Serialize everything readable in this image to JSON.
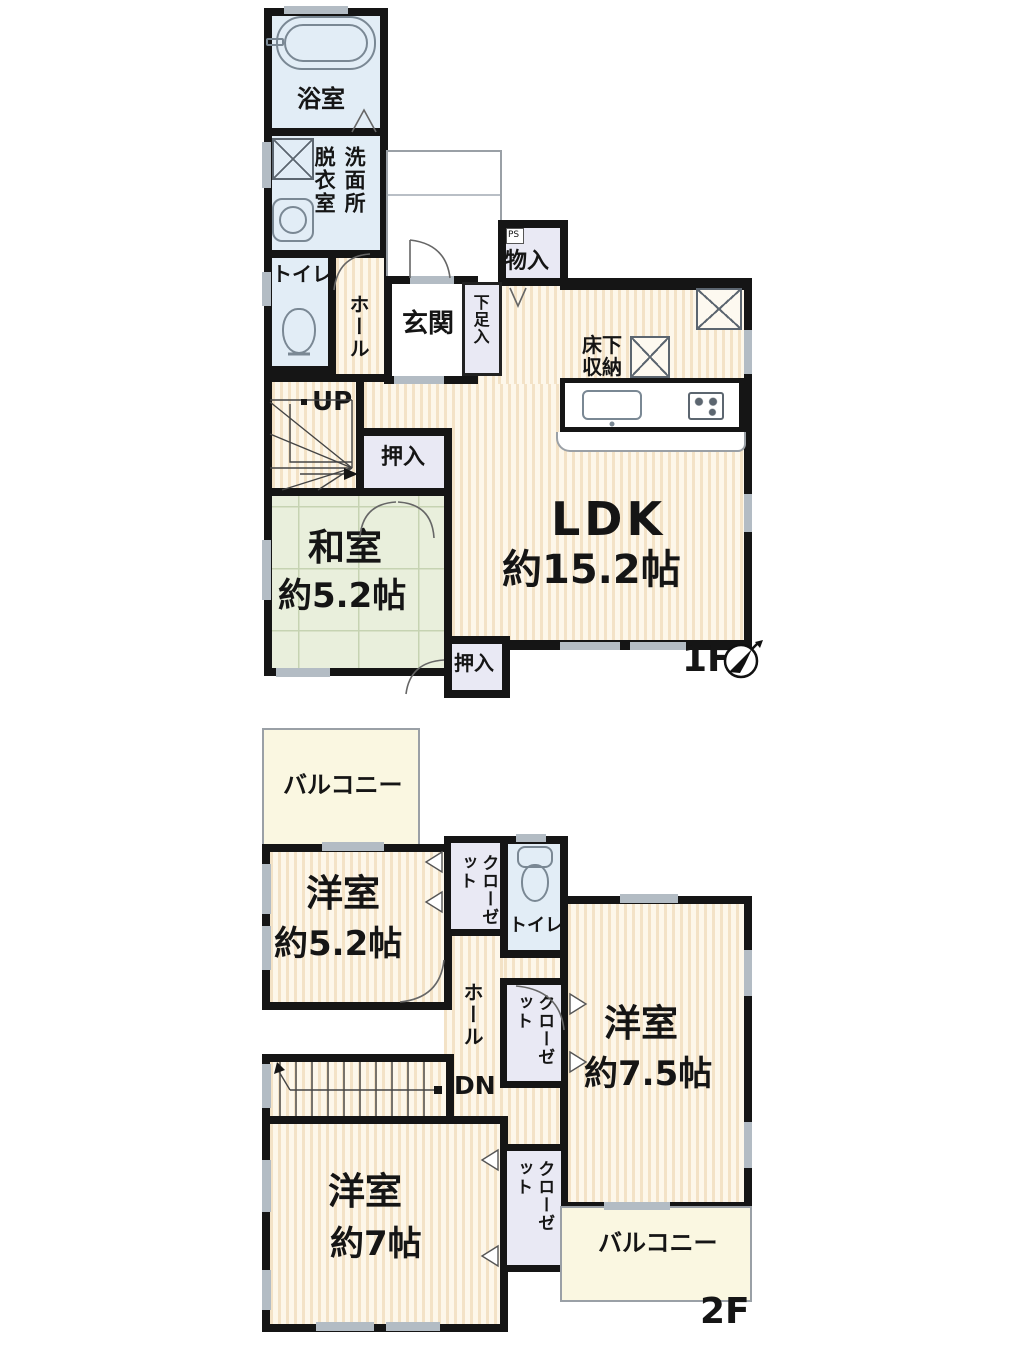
{
  "f1": {
    "label": "1F",
    "bath": "浴室",
    "dressing": "脱衣室",
    "washroom": "洗面所",
    "toilet": "トイレ",
    "hall": "ホール",
    "entrance": "玄関",
    "shoe_box": "下足入",
    "storage": "物入",
    "ps": "PS",
    "underfloor": "床下収納",
    "ldk": "LDK",
    "ldk_size": "約15.2帖",
    "up": "UP",
    "closet_a": "押入",
    "tatami_room": "和室",
    "tatami_size": "約5.2帖",
    "closet_b": "押入"
  },
  "f2": {
    "label": "2F",
    "balcony_a": "バルコニー",
    "room_a": "洋室",
    "room_a_size": "約5.2帖",
    "closet_a": "クローゼット",
    "toilet": "トイレ",
    "hall": "ホール",
    "dn": "DN",
    "room_b": "洋室",
    "room_b_size": "約7.5帖",
    "closet_b": "クローゼット",
    "room_c": "洋室",
    "room_c_size": "約7帖",
    "closet_c": "クローゼット",
    "balcony_b": "バルコニー"
  },
  "colors": {
    "wall": "#151515",
    "floor_stripe": "#f3e2c6",
    "floor_base": "#fdf7ea",
    "tatami": "#e9efdc",
    "wet_room": "#e2edf6",
    "closet": "#e9e9f4",
    "balcony": "#faf7e1"
  }
}
